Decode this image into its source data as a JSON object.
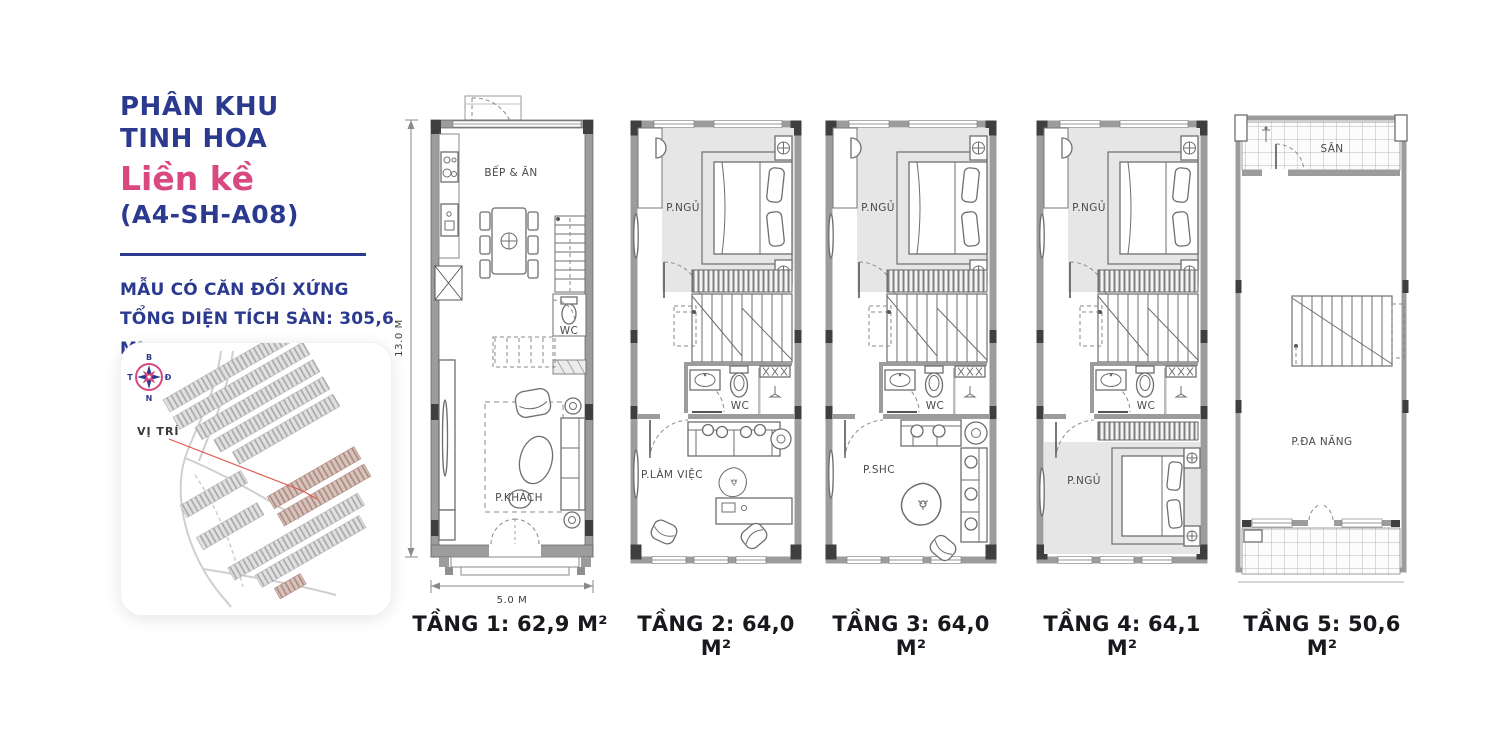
{
  "colors": {
    "navy": "#2b3a8f",
    "pink": "#d9487f",
    "caption_dark": "#18181d",
    "plan_wall_gray": "#9c9c9c",
    "room_shade": "#e6e6e6",
    "map_highlight": "#b5948b",
    "red_leader_line": "#e2574d"
  },
  "sidebar": {
    "subdivision": {
      "line1": "PHÂN KHU",
      "line2": "TINH HOA"
    },
    "product_type": "Liền kề",
    "unit_code": "(A4-SH-A08)",
    "notes": {
      "line1": "MẪU CÓ CĂN ĐỐI XỨNG",
      "line2": "TỔNG DIỆN TÍCH SÀN: 305,6 M²"
    },
    "map": {
      "location_label": "VỊ TRÍ",
      "compass": {
        "north": "B",
        "south": "N",
        "west": "T",
        "east": "Đ"
      }
    }
  },
  "floors": [
    {
      "name": "floor-1",
      "label": "TẦNG 1: 62,9 M²",
      "rooms": {
        "kitchen_dining": "BẾP & ĂN",
        "wc": "WC",
        "living": "P.KHÁCH"
      },
      "dimensions": {
        "depth": "13.0 M",
        "width": "5.0 M"
      }
    },
    {
      "name": "floor-2",
      "label": "TẦNG 2: 64,0 M²",
      "rooms": {
        "bedroom": "P.NGỦ",
        "wc": "WC",
        "office": "P.LÀM VIỆC"
      }
    },
    {
      "name": "floor-3",
      "label": "TẦNG 3: 64,0 M²",
      "rooms": {
        "bedroom": "P.NGỦ",
        "wc": "WC",
        "family": "P.SHC"
      }
    },
    {
      "name": "floor-4",
      "label": "TẦNG 4: 64,1 M²",
      "rooms": {
        "bedroom": "P.NGỦ",
        "wc": "WC",
        "bedroom_2": "P.NGỦ"
      }
    },
    {
      "name": "floor-5",
      "label": "TẦNG 5: 50,6 M²",
      "rooms": {
        "terrace": "SÂN",
        "multipurpose": "P.ĐA NĂNG"
      }
    }
  ]
}
